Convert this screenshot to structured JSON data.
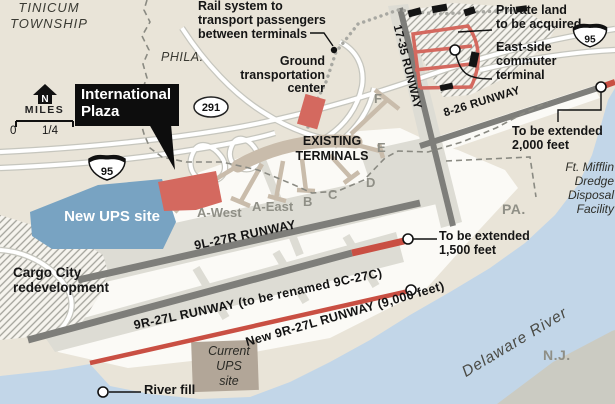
{
  "colors": {
    "land": "#e9e4d8",
    "airfield": "#fbfaf6",
    "taxiway": "#dddcd4",
    "runway_gray": "#7e7e7a",
    "new_construction_red": "#d4695f",
    "new_runway_red": "#c94f43",
    "ups_site_blue": "#78a3c2",
    "water_blue": "#c2d6e8",
    "nj_land_gray": "#cbcbc2",
    "terminal_tan": "#c9bcab"
  },
  "places": {
    "township": "TINICUM\nTOWNSHIP",
    "phila": "PHILA.",
    "pa": "PA.",
    "nj": "N.J.",
    "river": "Delaware River",
    "ft_mifflin": "Ft. Mifflin\nDredge\nDisposal\nFacility"
  },
  "annotations": {
    "rail": "Rail system to\ntransport passengers\nbetween terminals",
    "ground": "Ground\ntransportation\ncenter",
    "intl_plaza": "International\nPlaza",
    "private_land": "Private land\nto be acquired",
    "east_side": "East-side\ncommuter\nterminal",
    "ext_2000": "To be extended\n2,000 feet",
    "ext_1500": "To be extended\n1,500 feet",
    "new_ups": "New UPS site",
    "cargo": "Cargo City\nredevelopment",
    "current_ups": "Current\nUPS\nsite",
    "river_fill": "River fill",
    "existing_terminals": "EXISTING\nTERMINALS"
  },
  "runways": {
    "r17_35": "17-35 RUNWAY",
    "r8_26": "8-26 RUNWAY",
    "r9l_27r": "9L-27R RUNWAY",
    "r9r_27l": "9R-27L RUNWAY (to be renamed 9C-27C)",
    "new_9r_27l": "New 9R-27L RUNWAY (9,000 feet)"
  },
  "terminals": {
    "a_west": "A-West",
    "a_east": "A-East",
    "b": "B",
    "c": "C",
    "d": "D",
    "e": "E",
    "f": "F"
  },
  "shields": {
    "i95": "95",
    "route291": "291"
  },
  "scale": {
    "north": "N",
    "miles": "MILES",
    "zero": "0",
    "quarter": "1/4"
  }
}
